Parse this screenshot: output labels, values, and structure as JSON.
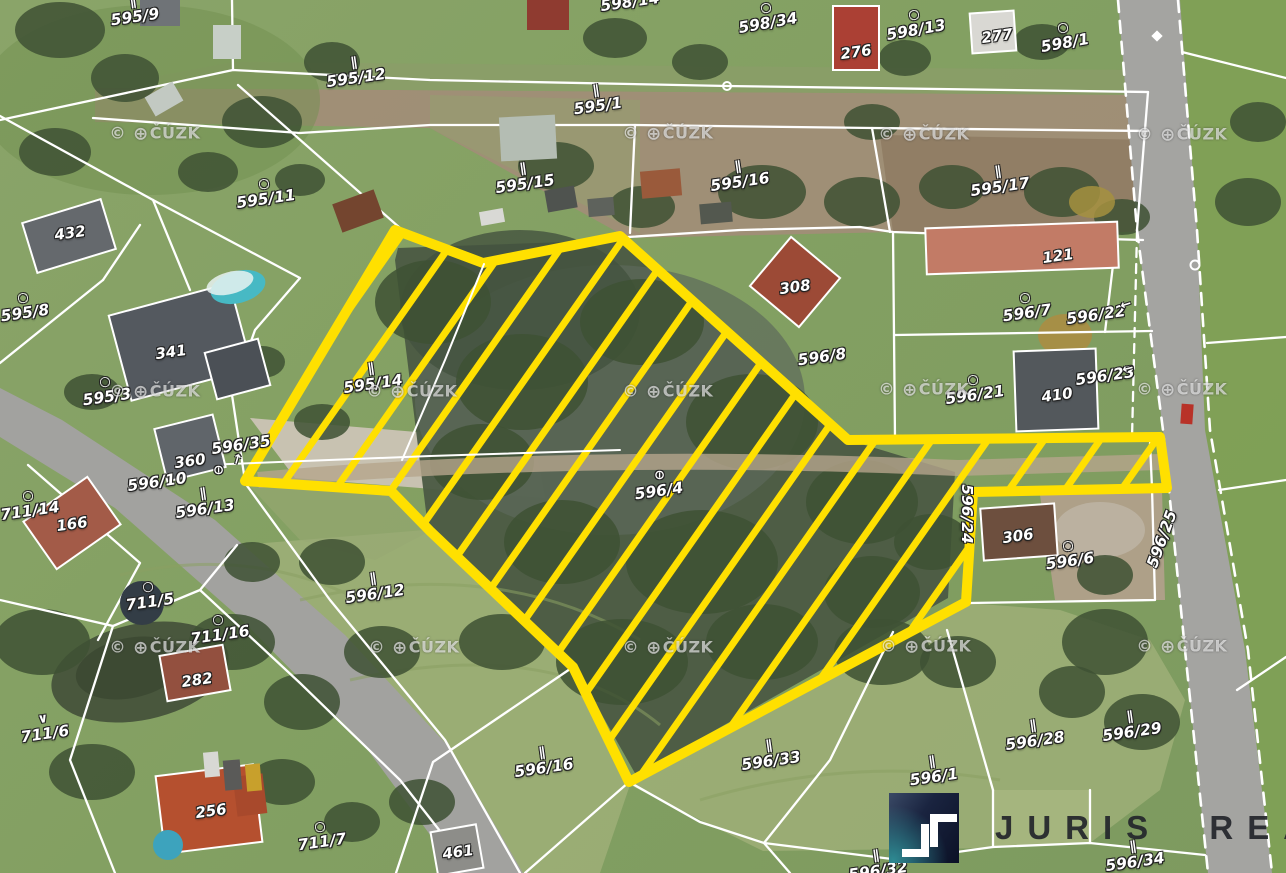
{
  "map": {
    "type": "cadastral-aerial-overlay",
    "highlight_color": "#FFE000",
    "highlighted_parcel": "596/4"
  },
  "watermark": {
    "prefix": "©",
    "globe_icon": "⊕",
    "text": "ČÚZK"
  },
  "logo": {
    "brand": "JURIS REAL",
    "monogram": "JT"
  },
  "parcel_labels": [
    {
      "text": "595/9",
      "x": 135,
      "y": 17,
      "rot": -8,
      "sym": "∥"
    },
    {
      "text": "598/14",
      "x": 630,
      "y": 2,
      "rot": -8
    },
    {
      "text": "598/34",
      "x": 768,
      "y": 23,
      "rot": -10,
      "sym": "○"
    },
    {
      "text": "598/13",
      "x": 916,
      "y": 30,
      "rot": -10,
      "sym": "○"
    },
    {
      "text": "598/1",
      "x": 1065,
      "y": 43,
      "rot": -10,
      "sym": "○"
    },
    {
      "text": "595/12",
      "x": 356,
      "y": 78,
      "rot": -8,
      "sym": "∥"
    },
    {
      "text": "595/1",
      "x": 598,
      "y": 106,
      "rot": -8,
      "sym": "∥"
    },
    {
      "text": "595/11",
      "x": 266,
      "y": 199,
      "rot": -8,
      "sym": "○"
    },
    {
      "text": "595/15",
      "x": 525,
      "y": 184,
      "rot": -8,
      "sym": "∥"
    },
    {
      "text": "595/16",
      "x": 740,
      "y": 182,
      "rot": -8,
      "sym": "∥"
    },
    {
      "text": "595/17",
      "x": 1000,
      "y": 187,
      "rot": -8,
      "sym": "∥"
    },
    {
      "text": "595/8",
      "x": 25,
      "y": 313,
      "rot": -8,
      "sym": "○"
    },
    {
      "text": "595/3",
      "x": 107,
      "y": 397,
      "rot": -8,
      "sym": "○"
    },
    {
      "text": "595/14",
      "x": 373,
      "y": 384,
      "rot": -8,
      "sym": "∥"
    },
    {
      "text": "596/8",
      "x": 822,
      "y": 357,
      "rot": -8
    },
    {
      "text": "596/7",
      "x": 1027,
      "y": 313,
      "rot": -8,
      "sym": "○"
    },
    {
      "text": "596/22",
      "x": 1096,
      "y": 315,
      "rot": -8
    },
    {
      "text": "596/21",
      "x": 975,
      "y": 395,
      "rot": -8,
      "sym": "○"
    },
    {
      "text": "596/23",
      "x": 1105,
      "y": 376,
      "rot": -8
    },
    {
      "text": "596/35",
      "x": 241,
      "y": 445,
      "rot": -8
    },
    {
      "text": "596/10",
      "x": 157,
      "y": 482,
      "rot": -8
    },
    {
      "text": "596/13",
      "x": 205,
      "y": 509,
      "rot": -8,
      "sym": "∥"
    },
    {
      "text": "711/14",
      "x": 30,
      "y": 511,
      "rot": -8,
      "sym": "○"
    },
    {
      "text": "596/4",
      "x": 659,
      "y": 491,
      "rot": -8
    },
    {
      "text": "596/24",
      "x": 967,
      "y": 514,
      "rot": 90
    },
    {
      "text": "596/25",
      "x": 1162,
      "y": 539,
      "rot": -70
    },
    {
      "text": "596/6",
      "x": 1070,
      "y": 561,
      "rot": -8,
      "sym": "○"
    },
    {
      "text": "596/12",
      "x": 375,
      "y": 594,
      "rot": -8,
      "sym": "∥"
    },
    {
      "text": "711/5",
      "x": 150,
      "y": 602,
      "rot": -8,
      "sym": "○"
    },
    {
      "text": "711/16",
      "x": 220,
      "y": 635,
      "rot": -8,
      "sym": "○"
    },
    {
      "text": "711/6",
      "x": 45,
      "y": 734,
      "rot": -8,
      "sym": "∨"
    },
    {
      "text": "711/7",
      "x": 322,
      "y": 842,
      "rot": -8,
      "sym": "○"
    },
    {
      "text": "596/16",
      "x": 544,
      "y": 768,
      "rot": -8,
      "sym": "∥"
    },
    {
      "text": "596/33",
      "x": 771,
      "y": 761,
      "rot": -8,
      "sym": "∥"
    },
    {
      "text": "596/1",
      "x": 934,
      "y": 777,
      "rot": -8,
      "sym": "∥"
    },
    {
      "text": "596/28",
      "x": 1035,
      "y": 741,
      "rot": -8,
      "sym": "∥"
    },
    {
      "text": "596/29",
      "x": 1132,
      "y": 732,
      "rot": -8,
      "sym": "∥"
    },
    {
      "text": "596/34",
      "x": 1135,
      "y": 862,
      "rot": -8,
      "sym": "∥"
    },
    {
      "text": "596/32",
      "x": 878,
      "y": 871,
      "rot": -8,
      "sym": "∥"
    }
  ],
  "building_labels": [
    {
      "text": "432",
      "x": 70,
      "y": 233
    },
    {
      "text": "341",
      "x": 171,
      "y": 352
    },
    {
      "text": "360",
      "x": 190,
      "y": 461
    },
    {
      "text": "166",
      "x": 72,
      "y": 524
    },
    {
      "text": "282",
      "x": 197,
      "y": 680
    },
    {
      "text": "256",
      "x": 211,
      "y": 811
    },
    {
      "text": "461",
      "x": 458,
      "y": 852
    },
    {
      "text": "276",
      "x": 856,
      "y": 52
    },
    {
      "text": "277",
      "x": 997,
      "y": 36
    },
    {
      "text": "121",
      "x": 1058,
      "y": 256
    },
    {
      "text": "308",
      "x": 795,
      "y": 287
    },
    {
      "text": "410",
      "x": 1057,
      "y": 395
    },
    {
      "text": "306",
      "x": 1018,
      "y": 536
    }
  ],
  "map_symbols": [
    {
      "icon": "⊖",
      "x": 218,
      "y": 470,
      "rot": 90
    },
    {
      "icon": "⊖",
      "x": 659,
      "y": 475,
      "rot": 90
    },
    {
      "icon": "←",
      "x": 1126,
      "y": 305,
      "rot": -18
    },
    {
      "icon": "←",
      "x": 1128,
      "y": 369,
      "rot": -14
    },
    {
      "icon": "↑",
      "x": 237,
      "y": 460,
      "rot": 16
    }
  ],
  "watermark_positions": [
    [
      155,
      134
    ],
    [
      668,
      134
    ],
    [
      924,
      135
    ],
    [
      1182,
      135
    ],
    [
      155,
      392
    ],
    [
      412,
      392
    ],
    [
      668,
      392
    ],
    [
      924,
      390
    ],
    [
      1182,
      390
    ],
    [
      155,
      648
    ],
    [
      414,
      648
    ],
    [
      668,
      648
    ],
    [
      926,
      647
    ],
    [
      1182,
      647
    ]
  ]
}
